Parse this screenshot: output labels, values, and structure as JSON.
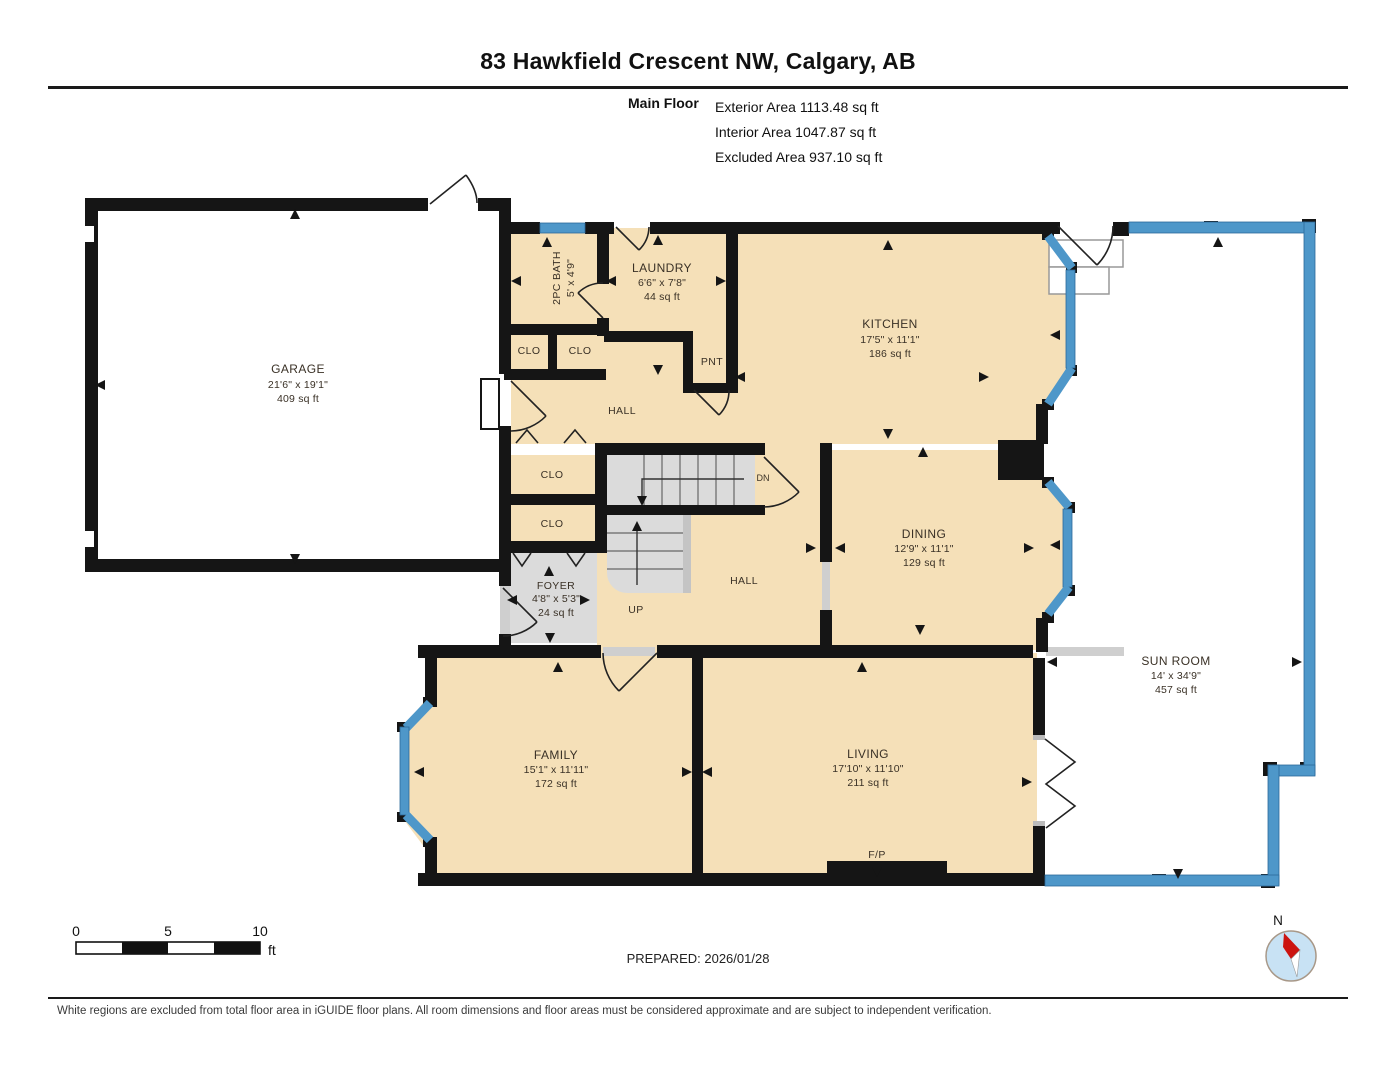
{
  "header": {
    "title": "83 Hawkfield Crescent NW, Calgary, AB",
    "floor_label": "Main Floor",
    "stats": [
      "Exterior Area 1113.48 sq ft",
      "Interior Area 1047.87 sq ft",
      "Excluded Area 937.10 sq ft"
    ]
  },
  "plan": {
    "rooms": {
      "garage": {
        "name": "GARAGE",
        "dims": "21'6\" x 19'1\"",
        "area": "409 sq ft"
      },
      "bath": {
        "name": "2PC BATH",
        "dims": "5' x 4'9\""
      },
      "laundry": {
        "name": "LAUNDRY",
        "dims": "6'6\" x 7'8\"",
        "area": "44 sq ft"
      },
      "kitchen": {
        "name": "KITCHEN",
        "dims": "17'5\" x 11'1\"",
        "area": "186 sq ft"
      },
      "dining": {
        "name": "DINING",
        "dims": "12'9\" x 11'1\"",
        "area": "129 sq ft"
      },
      "sunroom": {
        "name": "SUN ROOM",
        "dims": "14' x 34'9\"",
        "area": "457 sq ft"
      },
      "family": {
        "name": "FAMILY",
        "dims": "15'1\" x 11'11\"",
        "area": "172 sq ft"
      },
      "living": {
        "name": "LIVING",
        "dims": "17'10\" x 11'10\"",
        "area": "211 sq ft"
      },
      "foyer": {
        "name": "FOYER",
        "dims": "4'8\" x 5'3\"",
        "area": "24 sq ft"
      }
    },
    "labels": {
      "hall": "HALL",
      "clo": "CLO",
      "pnt": "PNT",
      "up": "UP",
      "dn": "DN",
      "fp": "F/P"
    }
  },
  "scale_bar": {
    "ticks": [
      "0",
      "5",
      "10"
    ],
    "unit": "ft"
  },
  "prepared_label": "PREPARED: 2026/01/28",
  "compass": {
    "north_label": "N"
  },
  "footer": {
    "disclaimer": "White regions are excluded from total floor area in iGUIDE floor plans. All room dimensions and floor areas must be considered approximate and are subject to independent verification."
  },
  "colors": {
    "wall": "#151515",
    "window_blue": "#4E97C9",
    "room_fill": "#F5E0B8",
    "excluded_fill": "#FFFFFF",
    "gray_floor": "#DBDBDB",
    "compass_fill": "#C8E2F4",
    "needle_red": "#CC1410"
  }
}
